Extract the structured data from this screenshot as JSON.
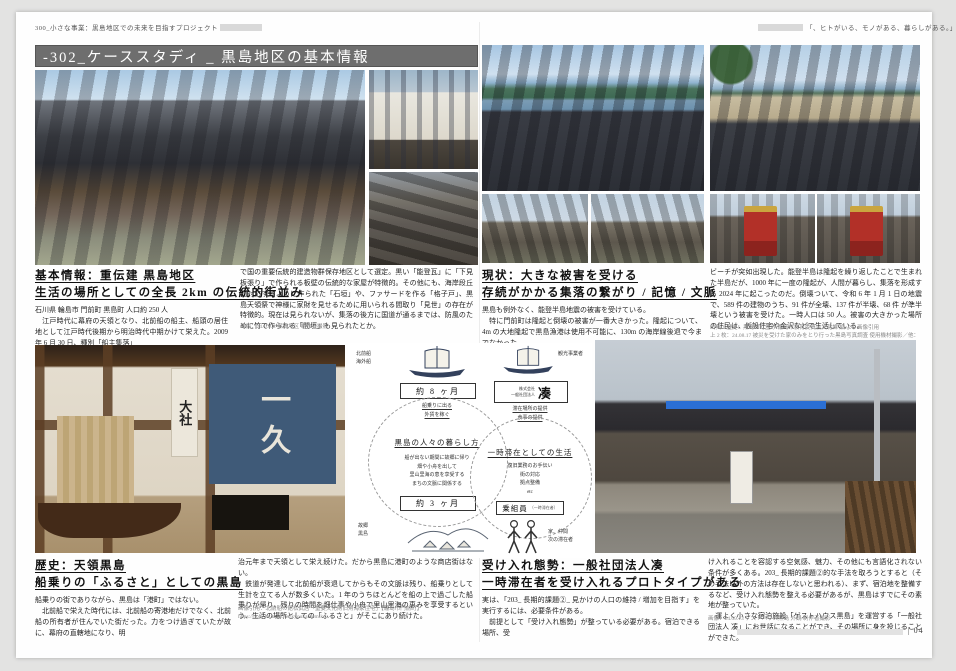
{
  "page": {
    "header_left": "300_小さな事業：黒島地区での未来を目指すプロジェクト",
    "header_right": "「、ヒトがいる、モノがある、暮らしがある。」",
    "title": "-302_ケーススタディ _ 黒島地区の基本情報",
    "page_number": "| 04"
  },
  "sections": [
    {
      "heading1": "基本情報：重伝建 黒島地区",
      "heading2": "生活の場所としての全長 2km の伝統的街並み",
      "col1": "石川県 輪島市 門前町 黒島町 人口約 250 人\n　江戸時代に幕府の天領となり、北前船の船主、船頭の居住地として江戸時代後期から明治時代中期かけて栄えた。2009 年 6 月 30 日、種別「船主集落」",
      "col2": "で国の重要伝統的建造物群保存地区として選定。黒い「能登瓦」に「下見板張り」で作られる板壁の伝統的な家屋が特徴的。その他にも、海岸段丘に対応するように作られた「石垣」や、ファサードを作る「格子戸」、黒島天領祭で神様に家財を見せるために用いられる間取り「見世」の存在が特徴的。現在は見られないが、集落の後方に国道が通るまでは、防風のために竹で作られる「間垣」も見られたとか。",
      "caption": "画像：24.10.02 黒島地区 制作者撮影"
    },
    {
      "heading1": "現状：大きな被害を受ける",
      "heading2": "存続がかかる集落の繋がり / 記憶 / 文脈",
      "col1": "黒島も例外なく、能登半島地震の被害を受けている。\n　特に門前町は隆起と倒壊の被害が一番大きかった。隆起について、4m の大地隆起で黒島漁港は使用不可能に、130m の海岸線後退で今までなかった",
      "col2": "ビーチが突如出現した。能登半島は隆起を繰り返したことで生まれた半島だが、1000 年に一度の隆起が、人間が暮らし、集落を形成する 2024 年に起こったのだ。倒壊ついて、令和 6 年 1 月 1 日の地震で、589 件の建物のうち、91 件が全壊、137 件が半壊、68 件 が準半壊という被害を受けた。一時人口は 50 人。被害の大きかった場所の住民は、仮設住宅や金沢などで生活している。",
      "caption": "出典・歴史：黒島の町並み 輪島市教育委員会文化課 編 より画像引用",
      "caption2": "上 2 枚：24.08.17 被災を受けた家のみをとり行った黒島写真調査 使用機材撮影／他：24.10.02 制作者撮影"
    },
    {
      "heading1": "歴史：天領黒島",
      "heading2": "船乗りの「ふるさと」としての黒島",
      "col1": "船乗りの街でありながら、黒島は「港町」ではない。\n　北前船で栄えた時代には、北前船の寄港地だけでなく、北前船の所有者が住んでいた街だった。力をつけ過ぎていたが故に、幕府の直轄地になり、明",
      "col2": "治元年まで天領として栄え続けた。だから黒島に港町のような商店街はない。\n　鉄道が発達して北前船が衰退してからもその文脈は残り、船乗りとして生計を立てる人が数多くいた。1 年のうちほとんどを船の上で過ごした船乗りが帰り、残りの時間を畑仕事や小舟で里山里海の恵みを享受するという、生活の場所としての「ふるさと」がそこにあり続けた。",
      "caption": "画像引用：北前船の館松武居「重要文化財旧角海家住宅」【輪島市門前町】",
      "caption2": "https://noto-tourism.net/kyoukaidomike"
    },
    {
      "heading1": "受け入れ態勢：一般社団法人凑",
      "heading2": "一時滞在者を受け入れるプロトタイプがある",
      "col1": "実は、「203_ 長期的課題②_ 見かけの人口の維持 / 増加を目指す」を実行するには、必要条件がある。\n　前提として「受け入れ態勢」が整っている必要がある。宿泊できる場所、受",
      "col2": "け入れることを容認する空気感、魅力、その他にも言語化されない条件が多くある。203_ 長期的課題②的な手法を取ろうとすると（その手法以外の方法は存在しないと思われる）、まず、宿泊地を整備するなど、受け入れ態勢を整える必要があるが、黒島はすでにその素地が整っていた。\n　運よく小さな宿泊施設「ゲストハウス黒島」を運営する「一般社団法人 凑」にお世話になることができ、その場所に身を投じることができた。",
      "caption": "画像：24.09.13 ゲストハウス黒島 外観 制作者撮影"
    }
  ],
  "diagram": {
    "boat1_label": "北前船\n海外船",
    "period1": "約 8 ヶ月",
    "action1": "船乗りに出る\n外貨を稼ぐ",
    "cycle1_title": "黒島の人々の暮らし方",
    "cycle1_note": "船が出ない期間に故郷に帰り\n畑や小舟を出して\n里山里海の恵を享受する\nまちの文脈に関係する",
    "period2": "約 3 ヶ月",
    "home_label": "故郷\n黒島",
    "boat2_label": "観光事業者",
    "org_small": "株式会社\n一般社団法人",
    "org_name": "凑",
    "action2": "滞在場所の提供\n食事の提供",
    "cycle2_title": "一時滞在としての生活",
    "cycle2_note": "復旧業務のお手伝い\n街の対応\n拠点整備\netc",
    "crew_label": "乗組員",
    "crew_sub": "（一時滞在者）",
    "people_label": "家、仲間\n次の滞在者"
  },
  "overlays": {
    "museum_banner": "一久",
    "museum_banner_side": "大社"
  }
}
